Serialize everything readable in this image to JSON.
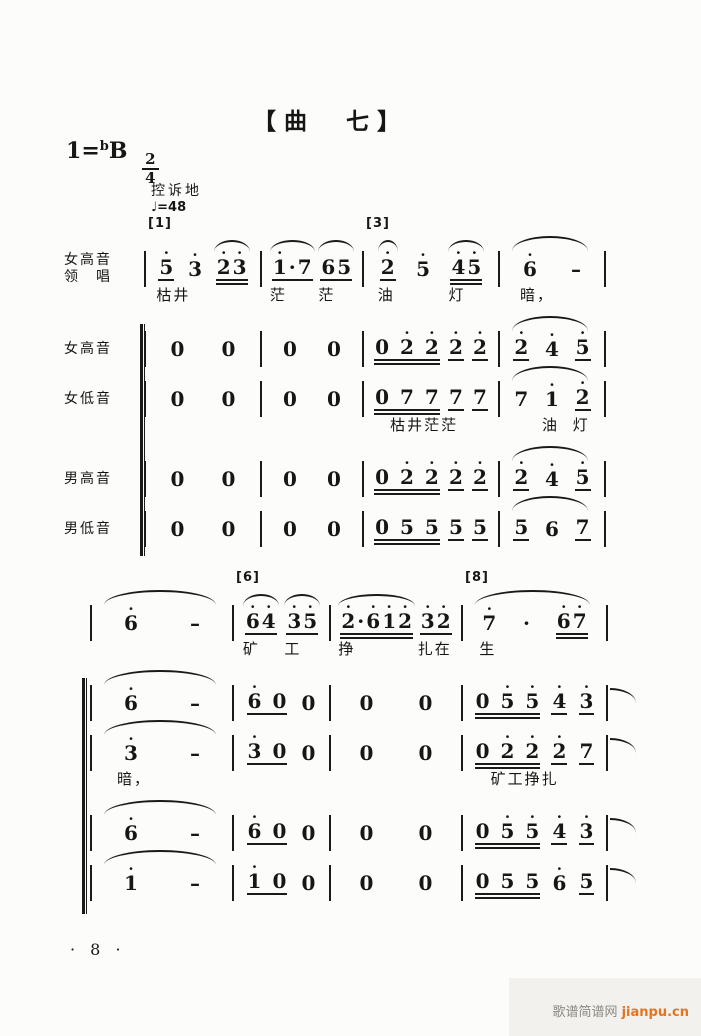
{
  "title": "【曲　七】",
  "key_signature": {
    "do": "1",
    "eq": "=",
    "flat": "b",
    "letter": "B",
    "meter_num": "2",
    "meter_den": "4"
  },
  "expression": "控诉地",
  "tempo": "♩=48",
  "page_number": "· 8 ·",
  "watermark": {
    "site": "歌谱简谱网",
    "url": "jianpu.cn"
  },
  "systems": [
    {
      "id": "system-1",
      "bracket": true,
      "rows": [
        {
          "id": "lead-soprano",
          "label": "女高音",
          "label2": "领　唱",
          "measures": [
            {
              "mark": "[1]",
              "tokens": [
                {
                  "t": "5",
                  "d": [
                    1
                  ],
                  "u": 1,
                  "lyr": "枯井"
                },
                {
                  "t": "3",
                  "d": [
                    1
                  ]
                },
                {
                  "t": "23",
                  "d": [
                    1,
                    1
                  ],
                  "u": 2,
                  "slur": true
                }
              ]
            },
            {
              "tokens": [
                {
                  "t": "1·7",
                  "d": [
                    1,
                    0,
                    0
                  ],
                  "u": 1,
                  "slur": true,
                  "lyr": "茫"
                },
                {
                  "t": "65",
                  "u": 1,
                  "slur": true,
                  "lyr": "茫"
                }
              ]
            },
            {
              "mark": "[3]",
              "tokens": [
                {
                  "t": "2",
                  "d": [
                    1
                  ],
                  "u": 1,
                  "slur": true,
                  "lyr": "油"
                },
                {
                  "t": "5",
                  "d": [
                    1
                  ]
                },
                {
                  "t": "45",
                  "d": [
                    1,
                    1
                  ],
                  "u": 2,
                  "slur": true,
                  "lyr": "灯"
                }
              ]
            },
            {
              "slur": true,
              "tokens": [
                {
                  "t": "6",
                  "d": [
                    1
                  ],
                  "lyr": "暗，"
                },
                {
                  "t": "–"
                }
              ]
            }
          ]
        },
        {
          "id": "soprano",
          "label": "女高音",
          "measures": [
            {
              "tokens": [
                {
                  "t": "0"
                },
                {
                  "t": "0"
                }
              ]
            },
            {
              "tokens": [
                {
                  "t": "0"
                },
                {
                  "t": "0"
                }
              ]
            },
            {
              "tokens": [
                {
                  "t": "0 2 2",
                  "d": [
                    0,
                    0,
                    1,
                    0,
                    1
                  ],
                  "u": 2
                },
                {
                  "t": "2",
                  "d": [
                    1
                  ],
                  "u": 1
                },
                {
                  "t": "2",
                  "d": [
                    1
                  ],
                  "u": 1
                }
              ]
            },
            {
              "slur": true,
              "tokens": [
                {
                  "t": "2",
                  "d": [
                    1
                  ],
                  "u": 1
                },
                {
                  "t": "4",
                  "d": [
                    1
                  ]
                },
                {
                  "t": "5",
                  "d": [
                    1
                  ],
                  "u": 1
                }
              ]
            }
          ]
        },
        {
          "id": "alto",
          "label": "女低音",
          "measures": [
            {
              "tokens": [
                {
                  "t": "0"
                },
                {
                  "t": "0"
                }
              ]
            },
            {
              "tokens": [
                {
                  "t": "0"
                },
                {
                  "t": "0"
                }
              ]
            },
            {
              "tokens": [
                {
                  "t": "0 7 7",
                  "u": 2,
                  "lyr": "枯井茫茫",
                  "lx": 16
                },
                {
                  "t": "7",
                  "u": 1
                },
                {
                  "t": "7",
                  "u": 1
                }
              ]
            },
            {
              "slur": true,
              "tokens": [
                {
                  "t": "7"
                },
                {
                  "t": "1",
                  "d": [
                    1
                  ],
                  "lyr": "油"
                },
                {
                  "t": "2",
                  "d": [
                    1
                  ],
                  "u": 1,
                  "lyr": "灯"
                }
              ]
            }
          ]
        },
        {
          "id": "tenor",
          "label": "男高音",
          "measures": [
            {
              "tokens": [
                {
                  "t": "0"
                },
                {
                  "t": "0"
                }
              ]
            },
            {
              "tokens": [
                {
                  "t": "0"
                },
                {
                  "t": "0"
                }
              ]
            },
            {
              "tokens": [
                {
                  "t": "0 2 2",
                  "d": [
                    0,
                    0,
                    1,
                    0,
                    1
                  ],
                  "u": 2
                },
                {
                  "t": "2",
                  "d": [
                    1
                  ],
                  "u": 1
                },
                {
                  "t": "2",
                  "d": [
                    1
                  ],
                  "u": 1
                }
              ]
            },
            {
              "slur": true,
              "tokens": [
                {
                  "t": "2",
                  "d": [
                    1
                  ],
                  "u": 1
                },
                {
                  "t": "4",
                  "d": [
                    1
                  ]
                },
                {
                  "t": "5",
                  "d": [
                    1
                  ],
                  "u": 1
                }
              ]
            }
          ]
        },
        {
          "id": "bass",
          "label": "男低音",
          "measures": [
            {
              "tokens": [
                {
                  "t": "0"
                },
                {
                  "t": "0"
                }
              ]
            },
            {
              "tokens": [
                {
                  "t": "0"
                },
                {
                  "t": "0"
                }
              ]
            },
            {
              "tokens": [
                {
                  "t": "0 5 5",
                  "u": 2
                },
                {
                  "t": "5",
                  "u": 1
                },
                {
                  "t": "5",
                  "u": 1
                }
              ]
            },
            {
              "slur": true,
              "tokens": [
                {
                  "t": "5",
                  "u": 1
                },
                {
                  "t": "6"
                },
                {
                  "t": "7",
                  "u": 1
                }
              ]
            }
          ]
        }
      ]
    },
    {
      "id": "system-2",
      "bracket": true,
      "rows": [
        {
          "id": "lead-soprano",
          "measures": [
            {
              "slur": true,
              "tokens": [
                {
                  "t": "6",
                  "d": [
                    1
                  ]
                },
                {
                  "t": "–"
                }
              ]
            },
            {
              "mark": "[6]",
              "tokens": [
                {
                  "t": "64",
                  "d": [
                    1,
                    1
                  ],
                  "u": 1,
                  "slur": true,
                  "lyr": "矿"
                },
                {
                  "t": "35",
                  "d": [
                    1,
                    1
                  ],
                  "u": 1,
                  "slur": true,
                  "lyr": "工"
                }
              ]
            },
            {
              "tokens": [
                {
                  "t": "2·612",
                  "d": [
                    1,
                    0,
                    1,
                    1,
                    1
                  ],
                  "u": 2,
                  "slur": true,
                  "lyr": "挣"
                },
                {
                  "t": "32",
                  "d": [
                    1,
                    1
                  ],
                  "u": 1,
                  "lyr": "扎在"
                }
              ]
            },
            {
              "mark": "[8]",
              "slur": true,
              "tokens": [
                {
                  "t": "7",
                  "d": [
                    1
                  ],
                  "lyr": "生"
                },
                {
                  "t": "·"
                },
                {
                  "t": "67",
                  "d": [
                    1,
                    1
                  ],
                  "u": 2
                }
              ]
            }
          ]
        },
        {
          "id": "soprano",
          "tie_end": true,
          "measures": [
            {
              "slur": true,
              "tokens": [
                {
                  "t": "6",
                  "d": [
                    1
                  ]
                },
                {
                  "t": "–"
                }
              ]
            },
            {
              "tokens": [
                {
                  "t": "6 0",
                  "d": [
                    1,
                    0,
                    0
                  ],
                  "u": 1
                },
                {
                  "t": "0"
                }
              ]
            },
            {
              "tokens": [
                {
                  "t": "0"
                },
                {
                  "t": "0"
                }
              ]
            },
            {
              "tokens": [
                {
                  "t": "0 5 5",
                  "d": [
                    0,
                    0,
                    1,
                    0,
                    1
                  ],
                  "u": 2
                },
                {
                  "t": "4",
                  "d": [
                    1
                  ],
                  "u": 1
                },
                {
                  "t": "3",
                  "d": [
                    1
                  ],
                  "u": 1
                }
              ]
            }
          ]
        },
        {
          "id": "alto",
          "tie_end": true,
          "measures": [
            {
              "slur": true,
              "tokens": [
                {
                  "t": "3",
                  "d": [
                    1
                  ],
                  "lyr": "暗，",
                  "lx": -6
                },
                {
                  "t": "–"
                }
              ]
            },
            {
              "tokens": [
                {
                  "t": "3 0",
                  "d": [
                    1,
                    0,
                    0
                  ],
                  "u": 1
                },
                {
                  "t": "0"
                }
              ]
            },
            {
              "tokens": [
                {
                  "t": "0"
                },
                {
                  "t": "0"
                }
              ]
            },
            {
              "tokens": [
                {
                  "t": "0 2 2",
                  "d": [
                    0,
                    0,
                    1,
                    0,
                    1
                  ],
                  "u": 2,
                  "lyr": "矿工挣扎",
                  "lx": 16
                },
                {
                  "t": "2",
                  "d": [
                    1
                  ],
                  "u": 1
                },
                {
                  "t": "7",
                  "u": 1
                }
              ]
            }
          ]
        },
        {
          "id": "tenor",
          "tie_end": true,
          "measures": [
            {
              "slur": true,
              "tokens": [
                {
                  "t": "6",
                  "d": [
                    1
                  ]
                },
                {
                  "t": "–"
                }
              ]
            },
            {
              "tokens": [
                {
                  "t": "6 0",
                  "d": [
                    1,
                    0,
                    0
                  ],
                  "u": 1
                },
                {
                  "t": "0"
                }
              ]
            },
            {
              "tokens": [
                {
                  "t": "0"
                },
                {
                  "t": "0"
                }
              ]
            },
            {
              "tokens": [
                {
                  "t": "0 5 5",
                  "d": [
                    0,
                    0,
                    1,
                    0,
                    1
                  ],
                  "u": 2
                },
                {
                  "t": "4",
                  "d": [
                    1
                  ],
                  "u": 1
                },
                {
                  "t": "3",
                  "d": [
                    1
                  ],
                  "u": 1
                }
              ]
            }
          ]
        },
        {
          "id": "bass",
          "tie_end": true,
          "measures": [
            {
              "slur": true,
              "tokens": [
                {
                  "t": "1",
                  "d": [
                    1
                  ]
                },
                {
                  "t": "–"
                }
              ]
            },
            {
              "tokens": [
                {
                  "t": "1 0",
                  "d": [
                    1,
                    0,
                    0
                  ],
                  "u": 1
                },
                {
                  "t": "0"
                }
              ]
            },
            {
              "tokens": [
                {
                  "t": "0"
                },
                {
                  "t": "0"
                }
              ]
            },
            {
              "tokens": [
                {
                  "t": "0 5 5",
                  "u": 2
                },
                {
                  "t": "6",
                  "d": [
                    1
                  ]
                },
                {
                  "t": "5",
                  "u": 1
                }
              ]
            }
          ]
        }
      ]
    }
  ]
}
